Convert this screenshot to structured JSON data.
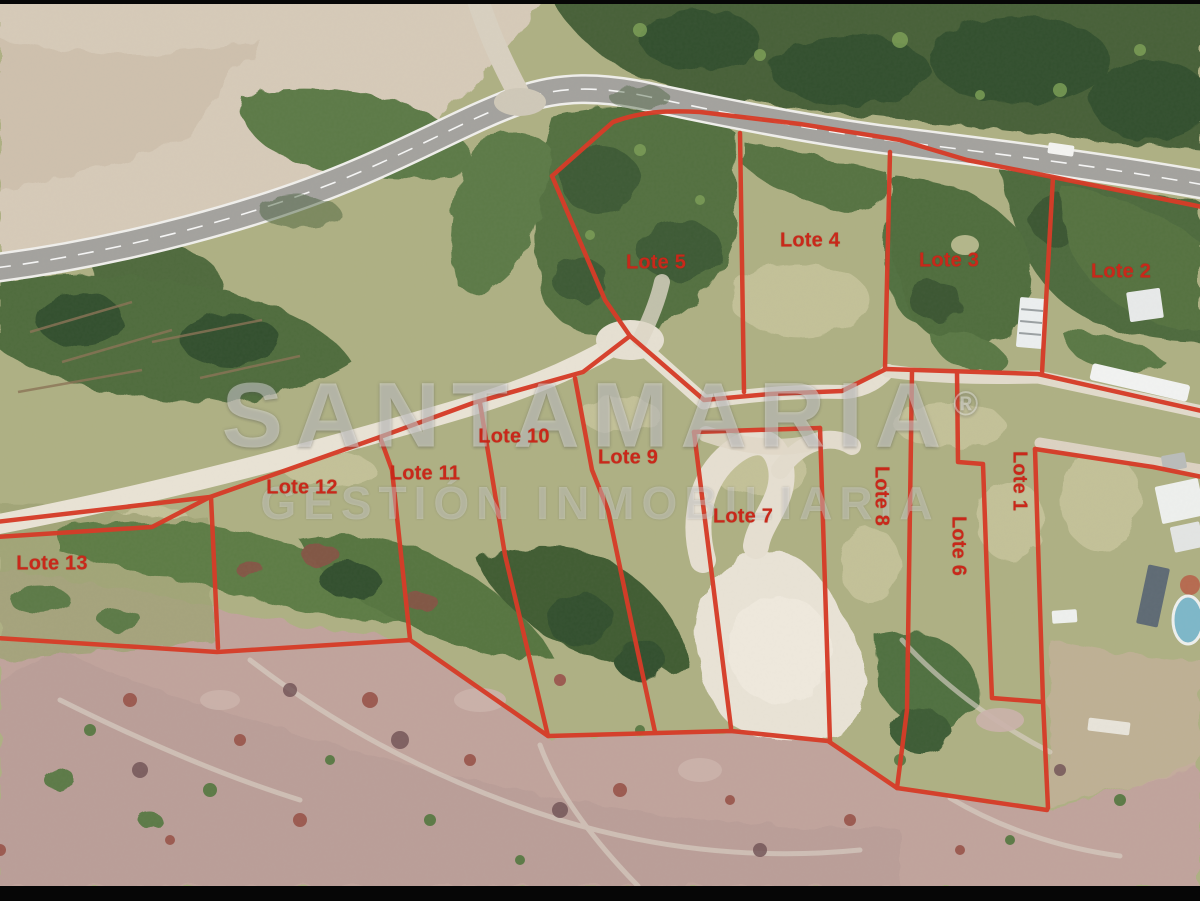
{
  "map": {
    "type": "aerial-lot-map",
    "lots": [
      {
        "label": "Lote 1",
        "x": 1019,
        "y": 481,
        "rotate": 90
      },
      {
        "label": "Lote 2",
        "x": 1121,
        "y": 272,
        "rotate": 0
      },
      {
        "label": "Lote 3",
        "x": 949,
        "y": 261,
        "rotate": 0
      },
      {
        "label": "Lote 4",
        "x": 810,
        "y": 241,
        "rotate": 0
      },
      {
        "label": "Lote 5",
        "x": 656,
        "y": 263,
        "rotate": 0
      },
      {
        "label": "Lote 6",
        "x": 958,
        "y": 546,
        "rotate": 90
      },
      {
        "label": "Lote 7",
        "x": 743,
        "y": 517,
        "rotate": 0
      },
      {
        "label": "Lote 8",
        "x": 881,
        "y": 496,
        "rotate": 90
      },
      {
        "label": "Lote 9",
        "x": 628,
        "y": 458,
        "rotate": 0
      },
      {
        "label": "Lote 10",
        "x": 514,
        "y": 437,
        "rotate": 0
      },
      {
        "label": "Lote 11",
        "x": 425,
        "y": 474,
        "rotate": 0
      },
      {
        "label": "Lote 12",
        "x": 302,
        "y": 488,
        "rotate": 0
      },
      {
        "label": "Lote 13",
        "x": 52,
        "y": 564,
        "rotate": 0
      }
    ],
    "watermark": {
      "brand": "SANTAMARIA",
      "registered_mark": "®",
      "tagline": "GESTIÓN INMOBILIARIA"
    },
    "colors": {
      "boundary_red": "#d63c28",
      "label_red": "#c9281a",
      "letterbox_black": "#060606"
    }
  }
}
